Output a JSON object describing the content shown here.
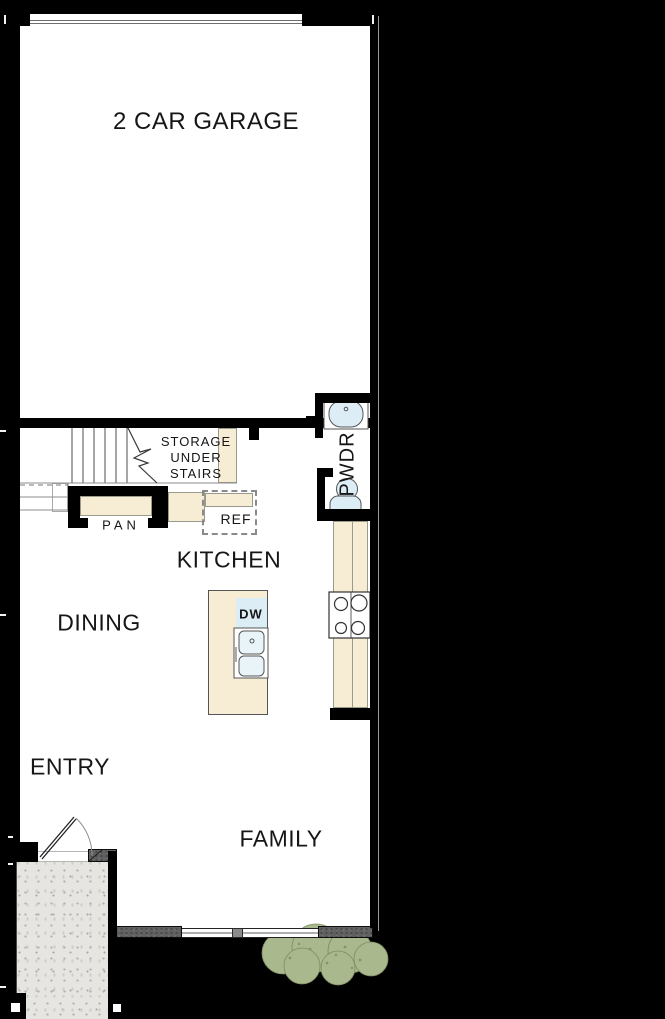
{
  "floorplan": {
    "title": "First floor plan",
    "rooms": {
      "garage": "2 CAR GARAGE",
      "kitchen": "KITCHEN",
      "dining": "DINING",
      "entry": "ENTRY",
      "family": "FAMILY",
      "powder": "PWDR"
    },
    "annotations": {
      "storage": "STORAGE\nUNDER\nSTAIRS",
      "pantry": "PAN",
      "refrigerator": "REF",
      "dishwasher": "DW"
    },
    "colors": {
      "background": "#000000",
      "wall": "#000000",
      "interior": "#ffffff",
      "counter_beige": "#f7ecd4",
      "fixture_blue": "#dcedf6",
      "porch_concrete": "#e6e5e1",
      "dark_wall_segment": "#616161",
      "shrub_green": "#a9b98d",
      "label_text": "#161616"
    }
  }
}
